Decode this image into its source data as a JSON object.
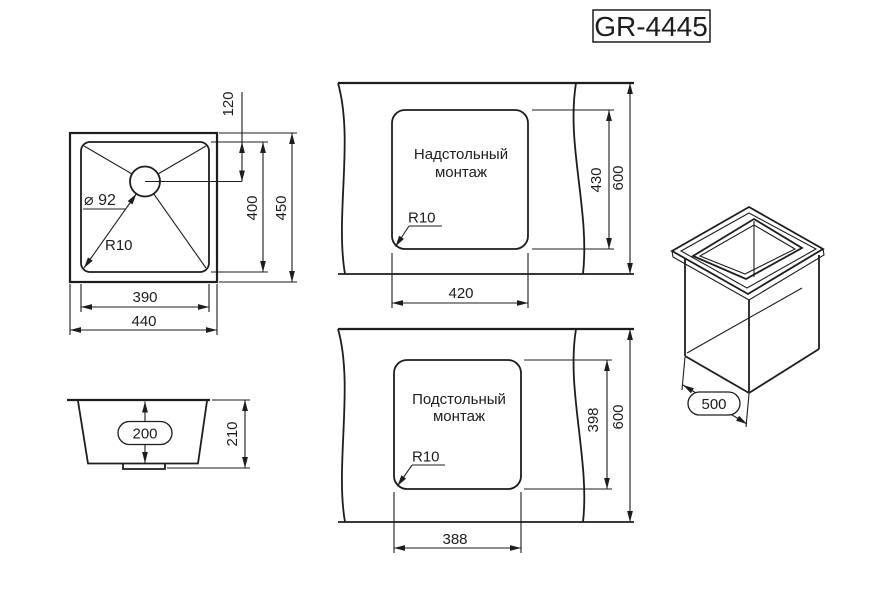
{
  "model": "GR-4445",
  "colors": {
    "line": "#1d1d1d",
    "background": "#ffffff"
  },
  "views": {
    "top": {
      "hole_offset": "120",
      "bowl_height": "400",
      "overall_height": "450",
      "bowl_width": "390",
      "overall_width": "440",
      "drain_diameter": "⌀ 92",
      "corner_radius": "R10"
    },
    "side": {
      "bowl_depth": "200",
      "overall_depth": "210"
    },
    "overmount": {
      "label_line1": "Надстольный",
      "label_line2": "монтаж",
      "corner_radius": "R10",
      "cutout_width": "420",
      "cutout_height": "430",
      "counter_depth": "600"
    },
    "undermount": {
      "label_line1": "Подстольный",
      "label_line2": "монтаж",
      "corner_radius": "R10",
      "cutout_width": "388",
      "cutout_height": "398",
      "counter_depth": "600"
    },
    "iso": {
      "cabinet_depth": "500"
    }
  }
}
